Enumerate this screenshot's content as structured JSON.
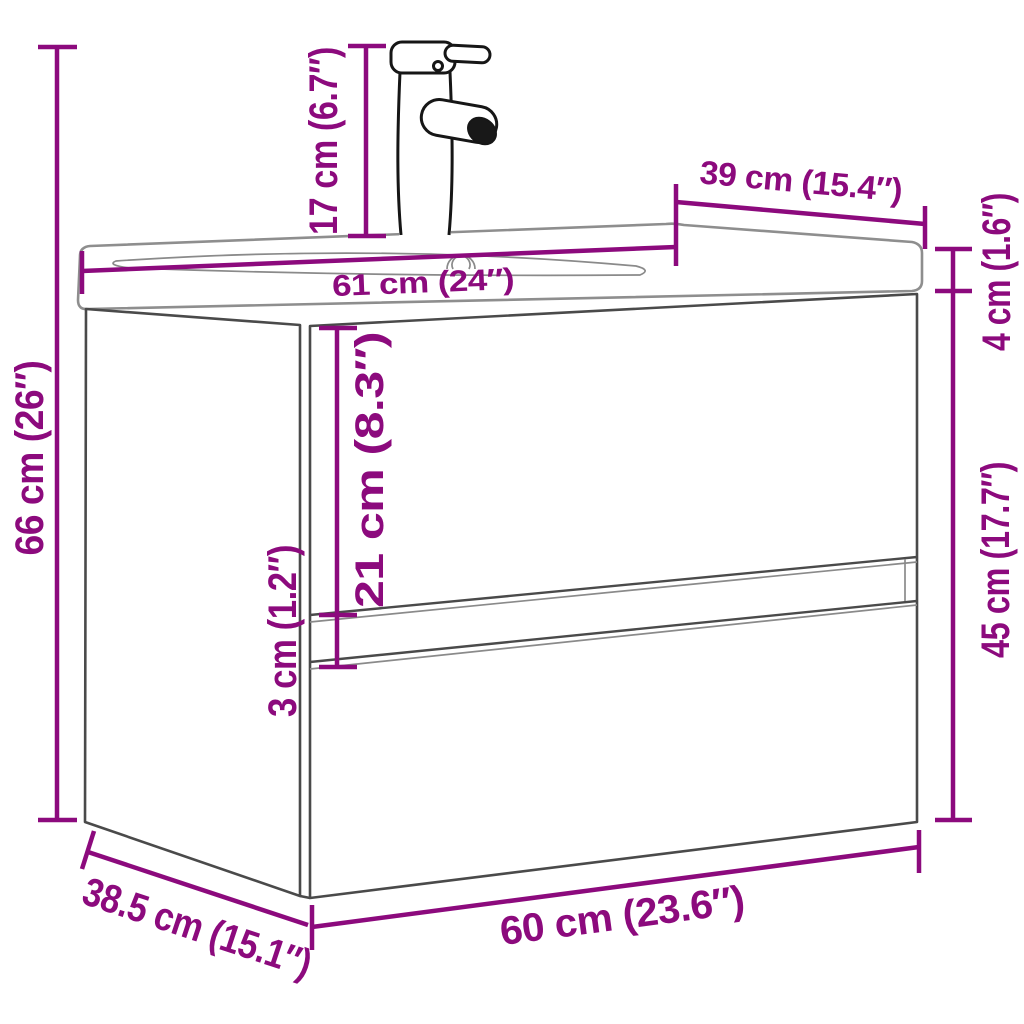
{
  "diagram": {
    "subject": "wall-mounted bathroom vanity cabinet with integrated basin and faucet",
    "accent_color": "#8C0A7D",
    "outline_color": "#4a4a4a",
    "background_color": "#ffffff"
  },
  "dimensions": {
    "overall_height": "66 cm (26″)",
    "faucet_height": "17 cm (6.7″)",
    "basin_width": "61 cm (24″)",
    "basin_depth": "39 cm (15.4″)",
    "basin_thickness": "4 cm (1.6″)",
    "cabinet_height": "45 cm (17.7″)",
    "drawer_front_height": "21 cm (8.3″)",
    "drawer_gap": "3 cm (1.2″)",
    "cabinet_width": "60 cm (23.6″)",
    "cabinet_depth": "38.5 cm (15.1″)"
  }
}
